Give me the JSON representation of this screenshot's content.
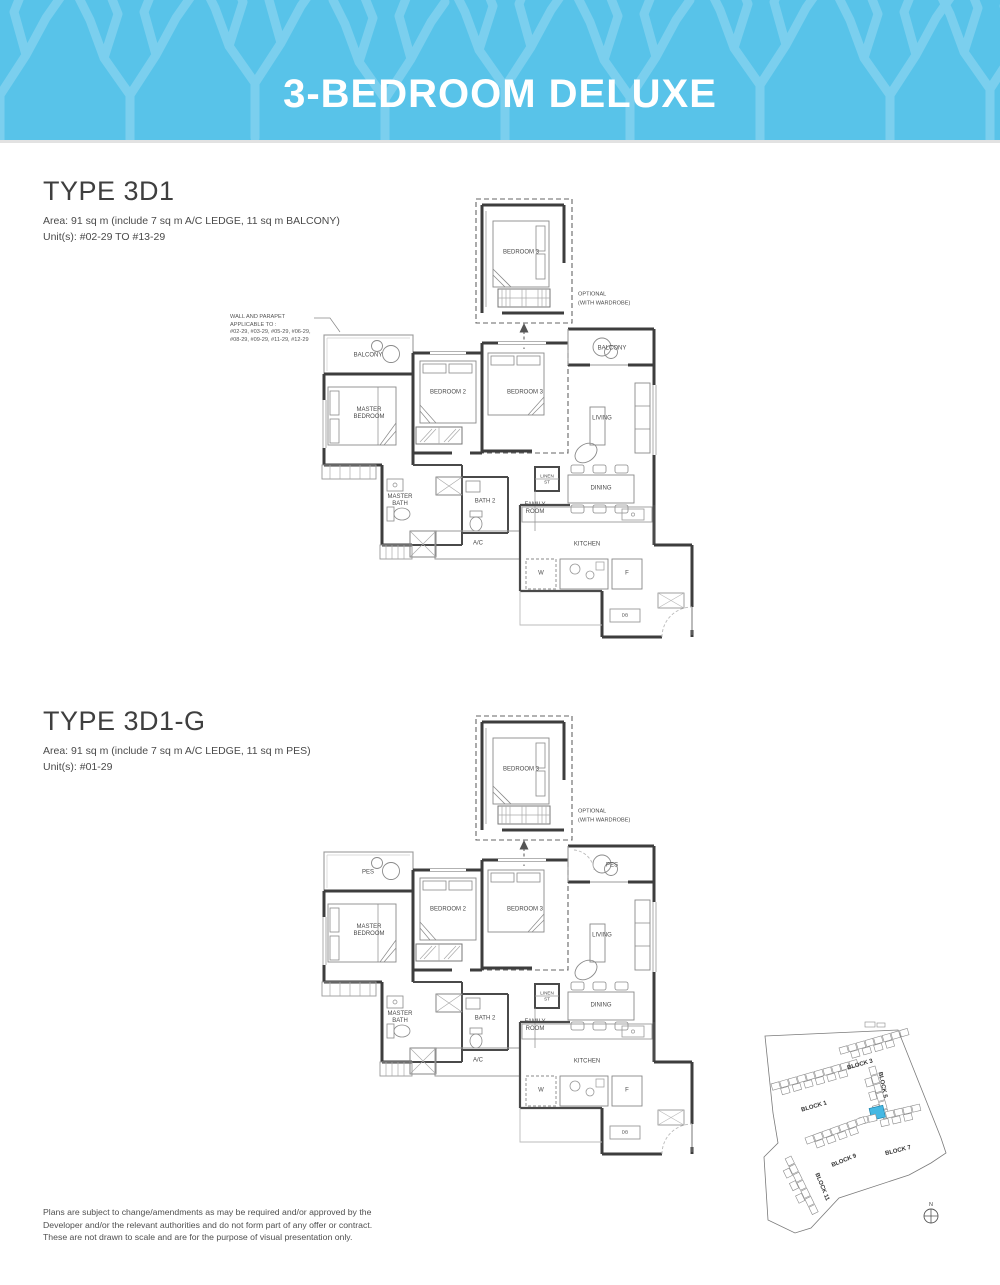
{
  "header": {
    "title": "3-BEDROOM DELUXE"
  },
  "colors": {
    "banner_blue": "#58c3e9",
    "banner_pattern": "#7bcfee",
    "plan_line_dark": "#3d3d3d",
    "site_highlight": "#45b8e3"
  },
  "plans": [
    {
      "type_title": "TYPE 3D1",
      "area_line": "Area: 91 sq m (include 7 sq m A/C LEDGE, 11 sq m BALCONY)",
      "units_line": "Unit(s): #02-29 TO #13-29",
      "note_lines": [
        "WALL AND PARAPET",
        "APPLICABLE TO :",
        "#02-29, #03-29, #05-29, #06-29,",
        "#08-29, #09-29, #11-29, #12-29"
      ],
      "labels": {
        "bedroom3_detached": "BEDROOM 3",
        "optional_1": "OPTIONAL",
        "optional_2": "(WITH WARDROBE)",
        "outdoor_left": "BALCONY",
        "outdoor_right": "BALCONY",
        "master_bedroom": "MASTER BEDROOM",
        "bedroom2": "BEDROOM 2",
        "bedroom3": "BEDROOM 3",
        "living": "LIVING",
        "dining": "DINING",
        "linen": "LINEN ST",
        "family_room": "FAMILY ROOM",
        "master_bath": "MASTER BATH",
        "bath2": "BATH 2",
        "ac": "A/C",
        "kitchen": "KITCHEN",
        "washer": "W",
        "fridge": "F",
        "db": "DB"
      }
    },
    {
      "type_title": "TYPE 3D1-G",
      "area_line": "Area: 91 sq m (include 7 sq m A/C LEDGE, 11 sq m PES)",
      "units_line": "Unit(s): #01-29",
      "labels": {
        "bedroom3_detached": "BEDROOM 3",
        "optional_1": "OPTIONAL",
        "optional_2": "(WITH WARDROBE)",
        "outdoor_left": "PES",
        "outdoor_right": "PES",
        "master_bedroom": "MASTER BEDROOM",
        "bedroom2": "BEDROOM 2",
        "bedroom3": "BEDROOM 3",
        "living": "LIVING",
        "dining": "DINING",
        "linen": "LINEN ST",
        "family_room": "FAMILY ROOM",
        "master_bath": "MASTER BATH",
        "bath2": "BATH 2",
        "ac": "A/C",
        "kitchen": "KITCHEN",
        "washer": "W",
        "fridge": "F",
        "db": "DB"
      }
    }
  ],
  "site_map": {
    "blocks": [
      "BLOCK 1",
      "BLOCK 3",
      "BLOCK 5",
      "BLOCK 7",
      "BLOCK 9",
      "BLOCK 11"
    ],
    "north_label": "N"
  },
  "disclaimer": {
    "lines": [
      "Plans are subject to change/amendments as may be required and/or approved by the",
      "Developer and/or the relevant authorities and do not form part of any offer or contract.",
      "These are not drawn to scale and are for the purpose of visual presentation only."
    ]
  }
}
